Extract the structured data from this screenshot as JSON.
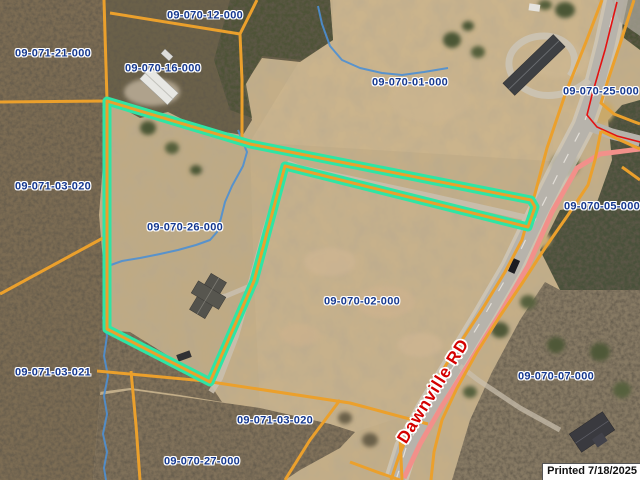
{
  "map": {
    "selected_parcel": "09-070-26-000",
    "parcel_labels": [
      {
        "text": "09-070-12-000",
        "x": 205,
        "y": 16
      },
      {
        "text": "09-071-21-000",
        "x": 53,
        "y": 54
      },
      {
        "text": "09-070-16-000",
        "x": 163,
        "y": 69
      },
      {
        "text": "09-070-01-000",
        "x": 410,
        "y": 83
      },
      {
        "text": "09-070-25-000",
        "x": 601,
        "y": 92
      },
      {
        "text": "09-071-03-020",
        "x": 53,
        "y": 187
      },
      {
        "text": "09-070-05-000",
        "x": 602,
        "y": 207
      },
      {
        "text": "09-070-26-000",
        "x": 185,
        "y": 228
      },
      {
        "text": "09-070-02-000",
        "x": 362,
        "y": 302
      },
      {
        "text": "09-071-03-021",
        "x": 53,
        "y": 373
      },
      {
        "text": "09-070-07-000",
        "x": 556,
        "y": 377
      },
      {
        "text": "09-071-03-020",
        "x": 275,
        "y": 421
      },
      {
        "text": "09-070-27-000",
        "x": 202,
        "y": 462
      }
    ],
    "road_label": {
      "text": "Dawnville RD",
      "x": 433,
      "y": 391,
      "rotation_deg": -58
    },
    "printed_label": "Printed 7/18/2025",
    "colors": {
      "parcel_line": "#EBA02C",
      "selected_outline": "#2FE5A4",
      "parcel_label_text": "#15388F",
      "road_label_text": "#D40000",
      "road_centerline": "#F2908A",
      "road_centerline_minor": "#E31212",
      "stream": "#4C8FD3"
    }
  }
}
